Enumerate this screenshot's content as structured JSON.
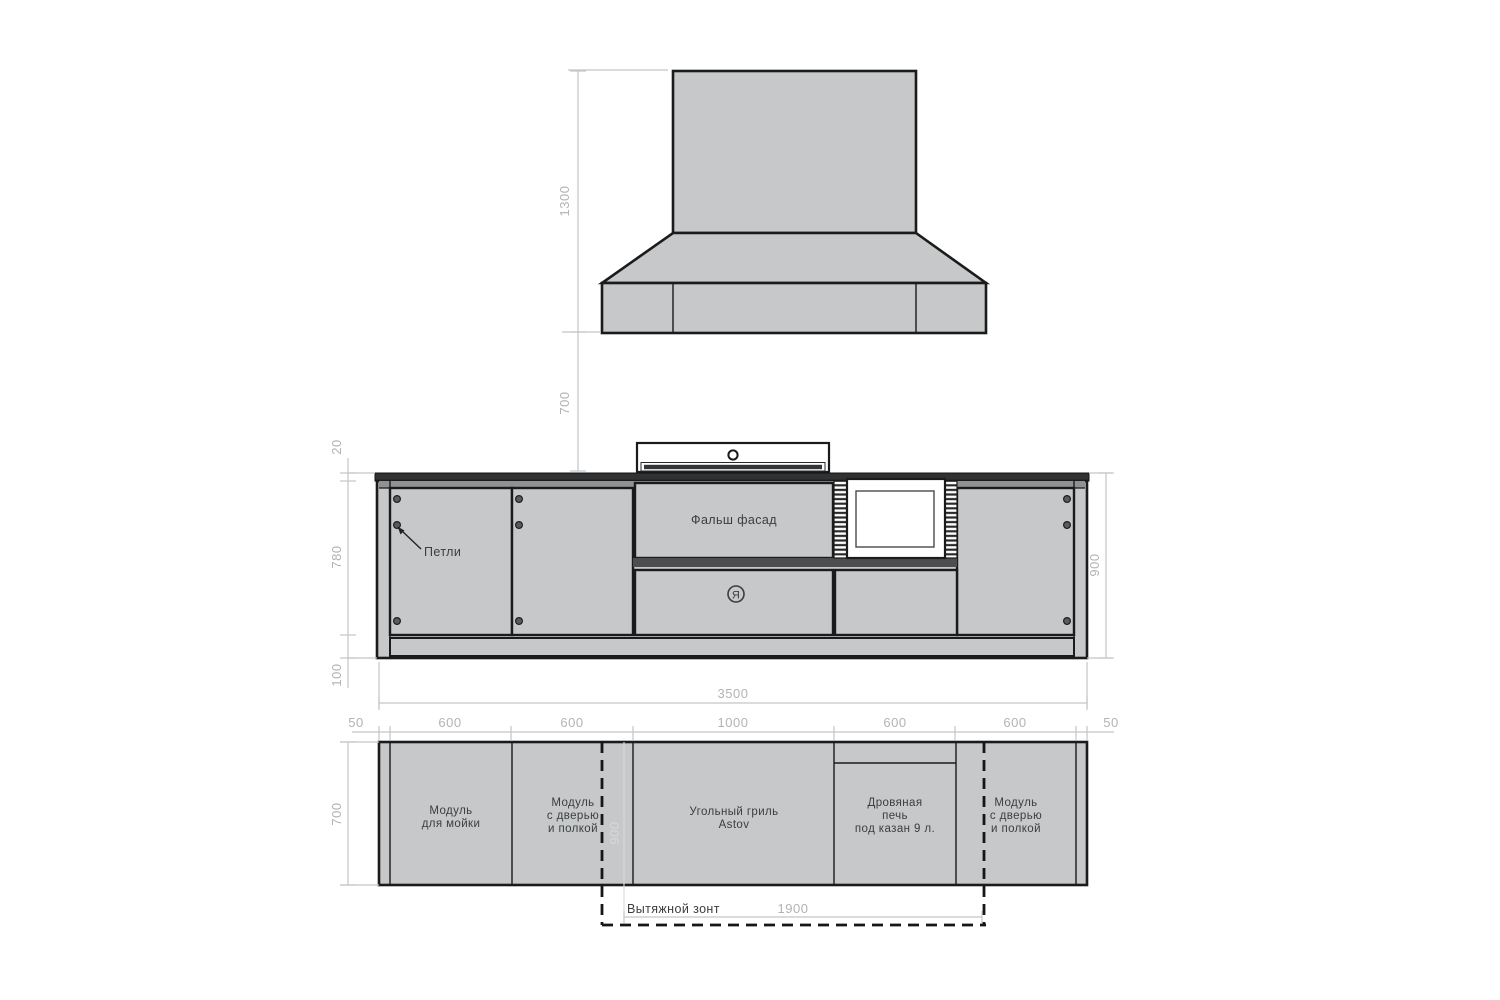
{
  "drawing_title": "Outdoor kitchen technical drawing",
  "colors": {
    "module_fill": "#c6c8c9",
    "outline": "#1b1b1b",
    "countertop": "#2f3132",
    "top_rail": "#8f9293",
    "dark_strip": "#4c4e4f",
    "dimension_line": "#c3c5c6",
    "dimension_text": "#b1b3b4",
    "label_text": "#3b3e40",
    "faint_dimension_text": "#d6d8d9"
  },
  "hood": {
    "height_dim": "1300",
    "clearance_dim": "700"
  },
  "elevation": {
    "hinges_label": "Петли",
    "false_facade_label": "Фальш фасад",
    "logo_letter": "Я",
    "dims": {
      "countertop_thickness": "20",
      "front_height": "780",
      "base_height": "100",
      "total_height": "900",
      "total_width": "3500"
    }
  },
  "plan": {
    "depth_dim": "700",
    "top_dims": [
      "50",
      "600",
      "600",
      "1000",
      "600",
      "600",
      "50"
    ],
    "modules": [
      {
        "lines": [
          "Модуль",
          "для мойки",
          ""
        ]
      },
      {
        "lines": [
          "Модуль",
          "с дверью",
          "и полкой"
        ]
      },
      {
        "lines": [
          "Угольный гриль",
          "Astov",
          ""
        ]
      },
      {
        "lines": [
          "Дровяная",
          "печь",
          "под казан 9 л."
        ]
      },
      {
        "lines": [
          "Модуль",
          "с дверью",
          "и полкой"
        ]
      }
    ],
    "hood_footprint": {
      "label": "Вытяжной зонт",
      "width_dim": "1900",
      "depth_dim": "900"
    }
  }
}
